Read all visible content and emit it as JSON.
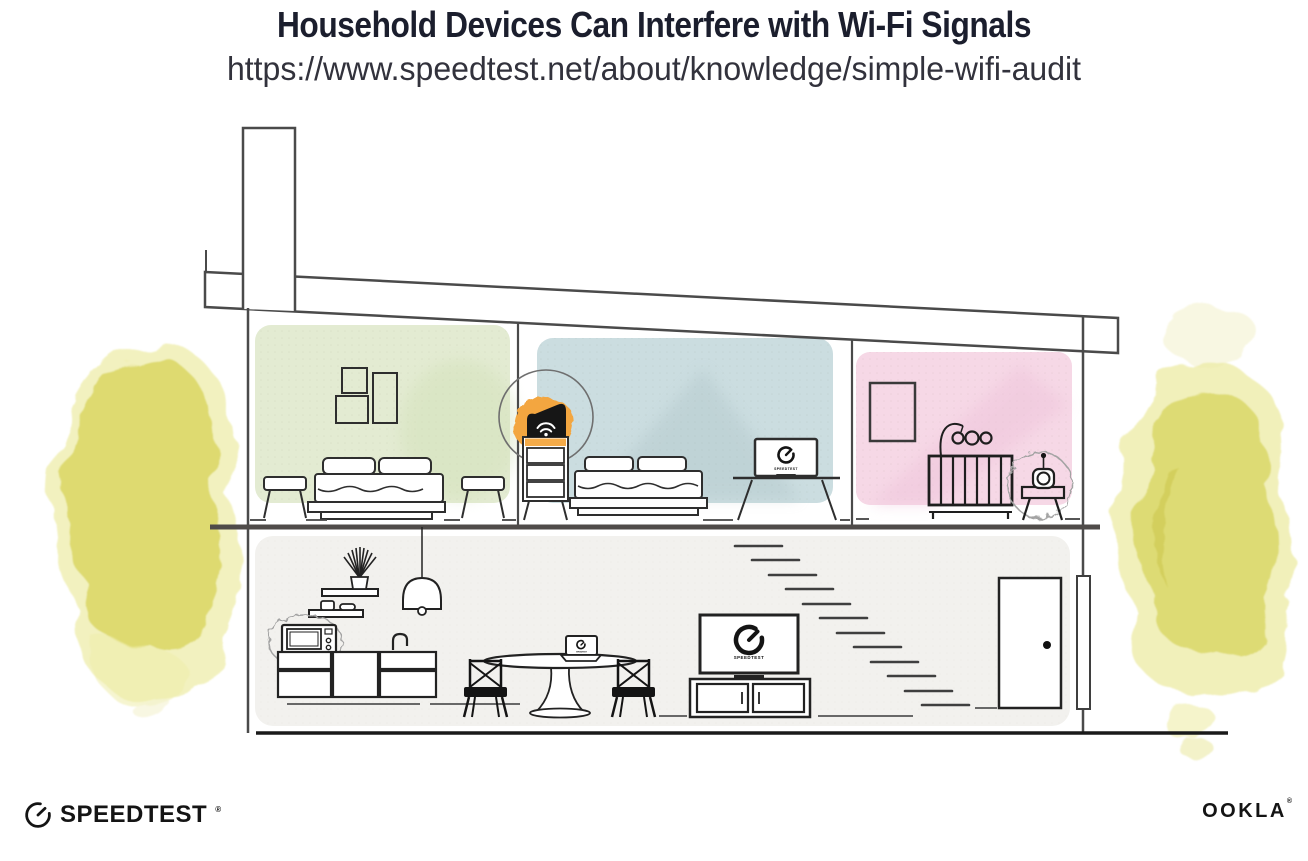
{
  "header": {
    "title": "Household Devices Can Interfere with Wi-Fi Signals",
    "url": "https://www.speedtest.net/about/knowledge/simple-wifi-audit"
  },
  "branding": {
    "speedtest_wordmark": "SPEEDTEST",
    "speedtest_reg": "®",
    "ookla_wordmark": "OOKLA",
    "ookla_reg": "®"
  },
  "screens": {
    "bedroom_monitor_label": "SPEEDTEST",
    "living_room_tv_label": "SPEEDTEST",
    "kitchen_laptop_label": "SPEEDTEST"
  },
  "colors": {
    "title_text": "#1b1e2d",
    "url_text": "#32323c",
    "logo_black": "#141414",
    "room_green": "#e3ebd2",
    "room_blue": "#cbdde0",
    "room_pink": "#f6d8e6",
    "room_gray": "#f2f1ee",
    "router_glow_orange": "#f3a63f",
    "foliage_yellow": "#dbd868",
    "foliage_yellow_light": "#eeeca9",
    "foliage_yellow_pale": "#f4f2cf",
    "line_dark": "#3a3a3a",
    "interference_gray": "#a3a3a3"
  }
}
